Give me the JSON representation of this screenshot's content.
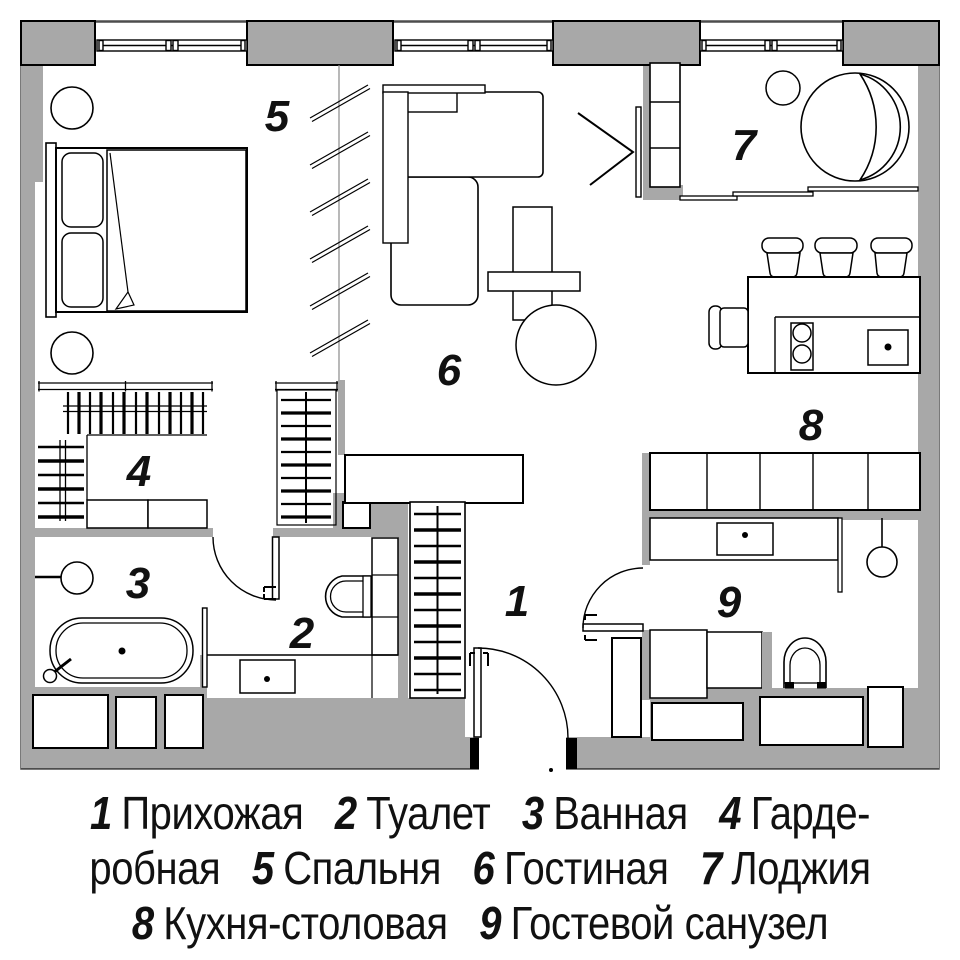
{
  "colors": {
    "wall_gray": "#a8a8a8",
    "line_black": "#000000",
    "outer_outline": "#4d4d4d",
    "background": "#ffffff"
  },
  "rooms": {
    "r1": {
      "num": "1",
      "name": "Прихожая"
    },
    "r2": {
      "num": "2",
      "name": "Туалет"
    },
    "r3": {
      "num": "3",
      "name": "Ванная"
    },
    "r4": {
      "num": "4",
      "name": "Гардеробная"
    },
    "r5": {
      "num": "5",
      "name": "Спальня"
    },
    "r6": {
      "num": "6",
      "name": "Гостиная"
    },
    "r7": {
      "num": "7",
      "name": "Лоджия"
    },
    "r8": {
      "num": "8",
      "name": "Кухня-столовая"
    },
    "r9": {
      "num": "9",
      "name": "Гостевой санузел"
    }
  },
  "legend": {
    "lines": [
      {
        "parts": [
          {
            "num": "1",
            "text": "Прихожая"
          },
          {
            "num": "2",
            "text": "Туалет"
          },
          {
            "num": "3",
            "text": "Ванная"
          },
          {
            "num": "4",
            "text": "Гарде-"
          }
        ]
      },
      {
        "parts": [
          {
            "num": "",
            "text": "робная"
          },
          {
            "num": "5",
            "text": "Спальня"
          },
          {
            "num": "6",
            "text": "Гостиная"
          },
          {
            "num": "7",
            "text": "Лоджия"
          }
        ]
      },
      {
        "parts": [
          {
            "num": "8",
            "text": "Кухня-столовая"
          },
          {
            "num": "9",
            "text": "Гостевой санузел"
          }
        ]
      }
    ]
  }
}
